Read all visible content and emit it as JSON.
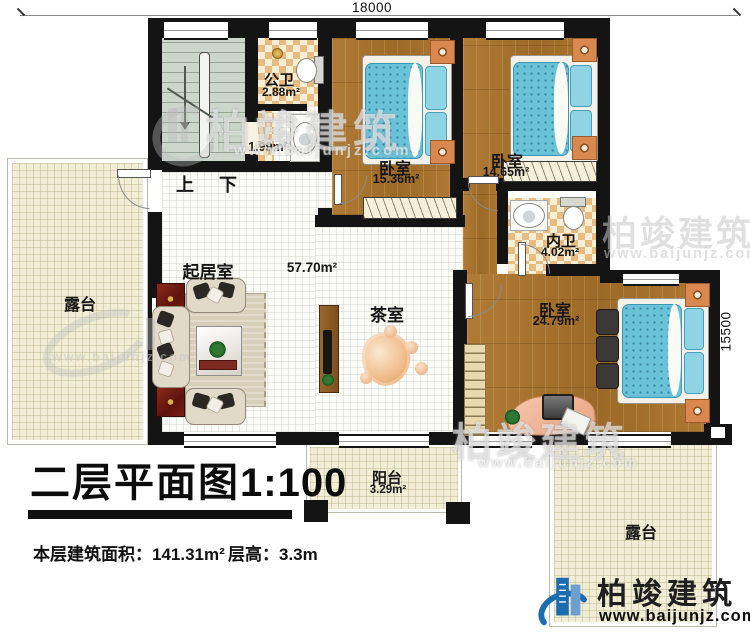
{
  "dimensions": {
    "width_top": "18000",
    "height_right": "15500"
  },
  "stairs": {
    "up": "上",
    "down": "下"
  },
  "rooms": {
    "public_bath": {
      "name": "公卫",
      "area": "2.88m²"
    },
    "wash": {
      "area": "1.99m²"
    },
    "bedroom1": {
      "name": "卧室",
      "area": "15.36m²"
    },
    "bedroom2": {
      "name": "卧室",
      "area": "14.65m²"
    },
    "ensuite_bath": {
      "name": "内卫",
      "area": "4.02m²"
    },
    "bedroom3": {
      "name": "卧室",
      "area": "24.79m²"
    },
    "living": {
      "name": "起居室",
      "area": "57.70m²"
    },
    "tea": {
      "name": "茶室"
    },
    "terrace_left": {
      "name": "露台"
    },
    "terrace_right": {
      "name": "露台"
    },
    "balcony": {
      "name": "阳台",
      "area": "3.29m²"
    }
  },
  "title": {
    "text": "二层平面图",
    "scale": "1:100"
  },
  "info": {
    "floor_area_label": "本层建筑面积：",
    "floor_area_value": "141.31m²",
    "height_label": "层高：",
    "height_value": "3.3m"
  },
  "branding": {
    "name": "柏竣建筑",
    "site": "www.baijunjz.com"
  },
  "watermark": {
    "name": "柏竣建筑",
    "site": "www.baijunjz.com"
  },
  "colors": {
    "wall": "#141414",
    "wood": "#a9742f",
    "checker": "#e6bc83",
    "terrace": "#f1edd6",
    "mattress": "#6ac2d9",
    "brand_blue": "#1e6cb0"
  }
}
